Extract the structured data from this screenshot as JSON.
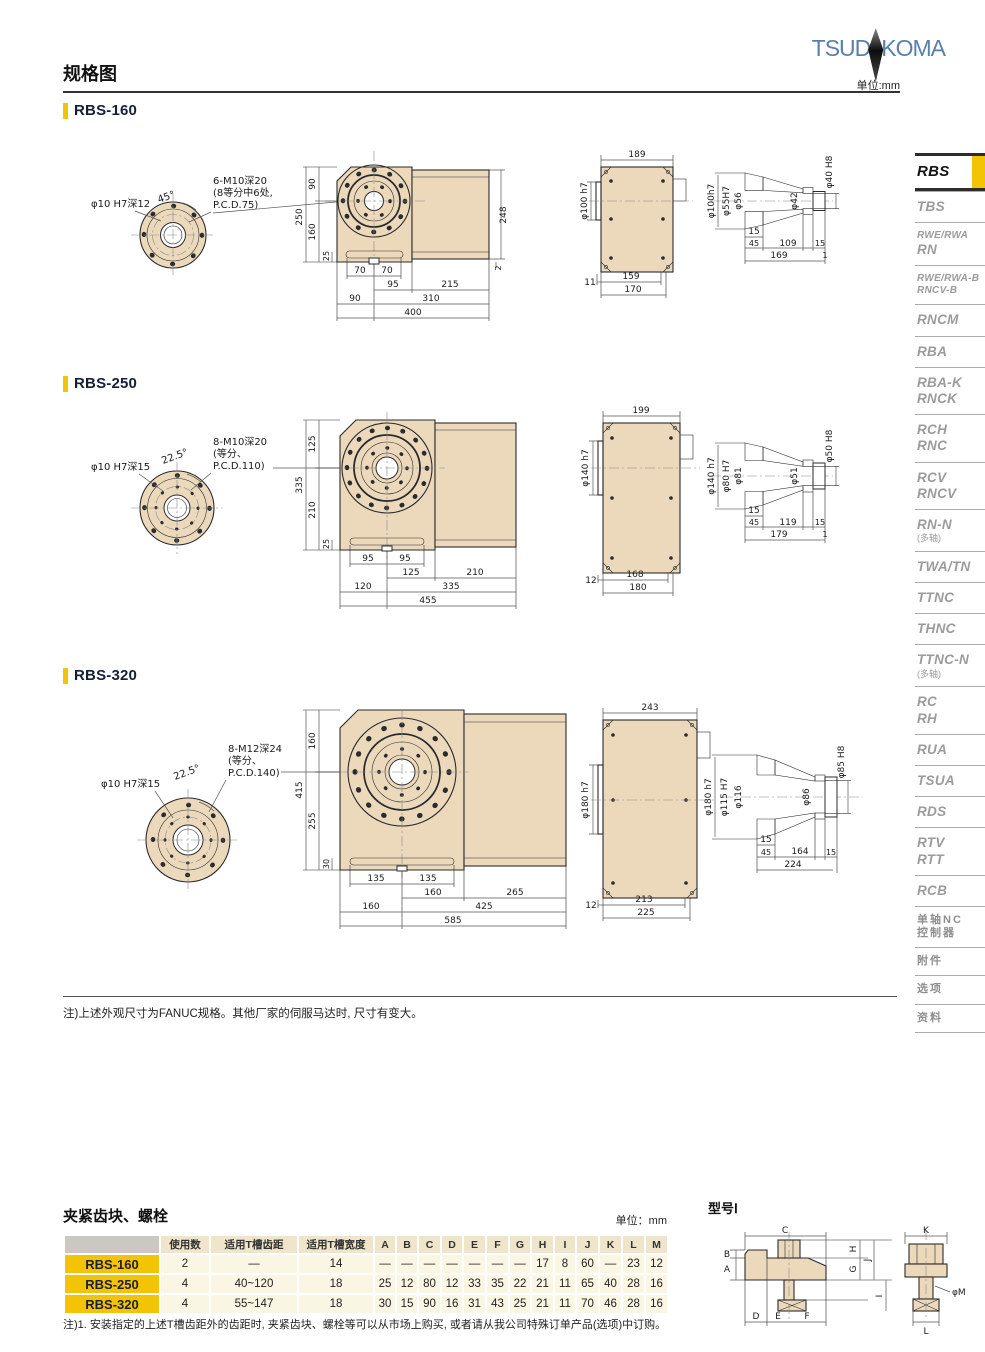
{
  "header": {
    "title": "规格图",
    "unit": "单位:mm",
    "logo_left": "TSUD",
    "logo_right": "KOMA"
  },
  "colors": {
    "accent": "#F3C306",
    "drawing_fill": "#ECD9BC",
    "logo_blue": "#5B7FAD",
    "sidebar_inactive": "#9B9B9B"
  },
  "sections": [
    {
      "title": "RBS-160",
      "flange": {
        "bore_label": "φ10 H7深12",
        "angle_label": "45°",
        "note1": "6-M10深20",
        "note2": "(8等分中6处,",
        "note3": "P.C.D.75)"
      },
      "front": {
        "total_h": "250",
        "top_h": "90",
        "bottom_h": "160",
        "base_h": "25",
        "b1l": "70",
        "b1r": "70",
        "b2l": "95",
        "b2r": "215",
        "b3l": "90",
        "b3r": "310",
        "b4": "400",
        "right_h": "248",
        "right_b": "2"
      },
      "top": {
        "w": "189",
        "dia": "φ100 h7",
        "off": "11",
        "w1": "159",
        "w2": "170"
      },
      "sec": {
        "d1": "φ100h7",
        "d2": "φ55H7",
        "d3": "φ56",
        "d4": "φ42",
        "d5": "φ40 H8",
        "t": "15",
        "l1": "45",
        "l2": "109",
        "l3": "15",
        "l4": "169",
        "l5": "1"
      }
    },
    {
      "title": "RBS-250",
      "flange": {
        "bore_label": "φ10 H7深15",
        "angle_label": "22.5°",
        "note1": "8-M10深20",
        "note2": "(等分、",
        "note3": "P.C.D.110)"
      },
      "front": {
        "total_h": "335",
        "top_h": "125",
        "bottom_h": "210",
        "base_h": "25",
        "b1l": "95",
        "b1r": "95",
        "b2l": "125",
        "b2r": "210",
        "b3l": "120",
        "b3r": "335",
        "b4": "455"
      },
      "top": {
        "w": "199",
        "dia": "φ140 h7",
        "off": "12",
        "w1": "168",
        "w2": "180"
      },
      "sec": {
        "d1": "φ140 h7",
        "d2": "φ80 H7",
        "d3": "φ81",
        "d4": "φ51",
        "d5": "φ50 H8",
        "t": "15",
        "l1": "45",
        "l2": "119",
        "l3": "15",
        "l4": "179",
        "l5": "1"
      }
    },
    {
      "title": "RBS-320",
      "flange": {
        "bore_label": "φ10 H7深15",
        "angle_label": "22.5°",
        "note1": "8-M12深24",
        "note2": "(等分、",
        "note3": "P.C.D.140)"
      },
      "front": {
        "total_h": "415",
        "top_h": "160",
        "bottom_h": "255",
        "base_h": "30",
        "b1l": "135",
        "b1r": "135",
        "b2l": "160",
        "b2r": "265",
        "b3l": "160",
        "b3r": "425",
        "b4": "585"
      },
      "top": {
        "w": "243",
        "dia": "φ180 h7",
        "off": "12",
        "w1": "213",
        "w2": "225"
      },
      "sec": {
        "d1": "φ180 h7",
        "d2": "φ115 H7",
        "d3": "φ116",
        "d4": "φ86",
        "d5": "φ85 H8",
        "t": "15",
        "l1": "45",
        "l2": "164",
        "l3": "15",
        "l4": "224"
      }
    }
  ],
  "drawings_note": "注)上述外观尺寸为FANUC规格。其他厂家的伺服马达时, 尺寸有变大。",
  "sidebar": {
    "items": [
      {
        "label": "RBS",
        "active": true
      },
      {
        "label": "TBS"
      },
      {
        "label": "RWE/RWA\nRN",
        "small_first": true
      },
      {
        "label": "RWE/RWA-B\nRNCV-B",
        "small": true
      },
      {
        "label": "RNCM"
      },
      {
        "label": "RBA"
      },
      {
        "label": "RBA-K\nRNCK"
      },
      {
        "label": "RCH\nRNC"
      },
      {
        "label": "RCV\nRNCV"
      },
      {
        "label": "RN-N\n(多轴)"
      },
      {
        "label": "TWA/TN"
      },
      {
        "label": "TTNC"
      },
      {
        "label": "THNC"
      },
      {
        "label": "TTNC-N\n(多轴)"
      },
      {
        "label": "RC\nRH"
      },
      {
        "label": "RUA"
      },
      {
        "label": "TSUA"
      },
      {
        "label": "RDS"
      },
      {
        "label": "RTV\nRTT"
      },
      {
        "label": "RCB"
      },
      {
        "label": "单轴NC\n控制器",
        "cn": true
      },
      {
        "label": "附件",
        "cn": true
      },
      {
        "label": "选项",
        "cn": true
      },
      {
        "label": "资料",
        "cn": true
      }
    ]
  },
  "clamp": {
    "title": "夹紧齿块、螺栓",
    "unit": "单位：mm",
    "headers": [
      "",
      "使用数",
      "适用T槽齿距",
      "适用T槽宽度",
      "A",
      "B",
      "C",
      "D",
      "E",
      "F",
      "G",
      "H",
      "I",
      "J",
      "K",
      "L",
      "M"
    ],
    "rows": [
      {
        "model": "RBS-160",
        "cells": [
          "2",
          "—",
          "14",
          "—",
          "—",
          "—",
          "—",
          "—",
          "—",
          "—",
          "17",
          "8",
          "60",
          "—",
          "23",
          "12"
        ]
      },
      {
        "model": "RBS-250",
        "cells": [
          "4",
          "40~120",
          "18",
          "25",
          "12",
          "80",
          "12",
          "33",
          "35",
          "22",
          "21",
          "11",
          "65",
          "40",
          "28",
          "16"
        ]
      },
      {
        "model": "RBS-320",
        "cells": [
          "4",
          "55~147",
          "18",
          "30",
          "15",
          "90",
          "16",
          "31",
          "43",
          "25",
          "21",
          "11",
          "70",
          "46",
          "28",
          "16"
        ]
      }
    ],
    "note": "注)1. 安装指定的上述T槽齿距外的齿距时, 夹紧齿块、螺栓等可以从市场上购买, 或者请从我公司特殊订单产品(选项)中订购。"
  },
  "model_diagram": {
    "title": "型号Ⅰ",
    "labels": {
      "A": "A",
      "B": "B",
      "C": "C",
      "D": "D",
      "E": "E",
      "F": "F",
      "G": "G",
      "H": "H",
      "I": "I",
      "J": "J",
      "K": "K",
      "L": "L",
      "phiM": "φM"
    }
  }
}
